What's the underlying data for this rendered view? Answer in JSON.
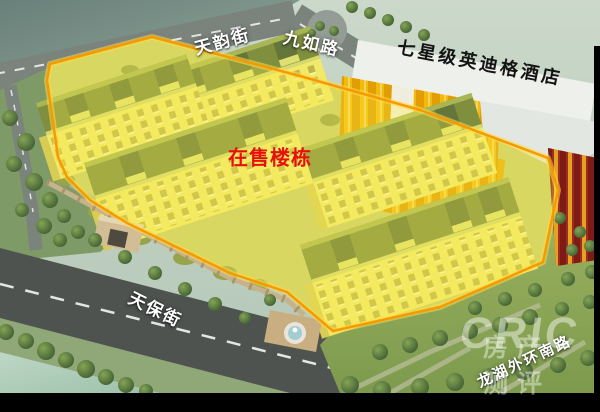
{
  "labels": {
    "street_tianyun": "天韵街",
    "street_jiuru": "九如路",
    "hotel_banner": "七星级英迪格酒店",
    "onsale": "在售楼栋",
    "street_tianbao": "天保街",
    "street_longhu": "龙湖外环南路"
  },
  "watermark": {
    "brand": "CRIC",
    "tagline": "房产测评"
  },
  "colors": {
    "highlight_outline": "#F59B00",
    "highlight_fill": "#FCEE46",
    "onsale_text": "#E8100C",
    "street_label_text": "#FFFFFF",
    "hotel_label_text": "#141414"
  }
}
